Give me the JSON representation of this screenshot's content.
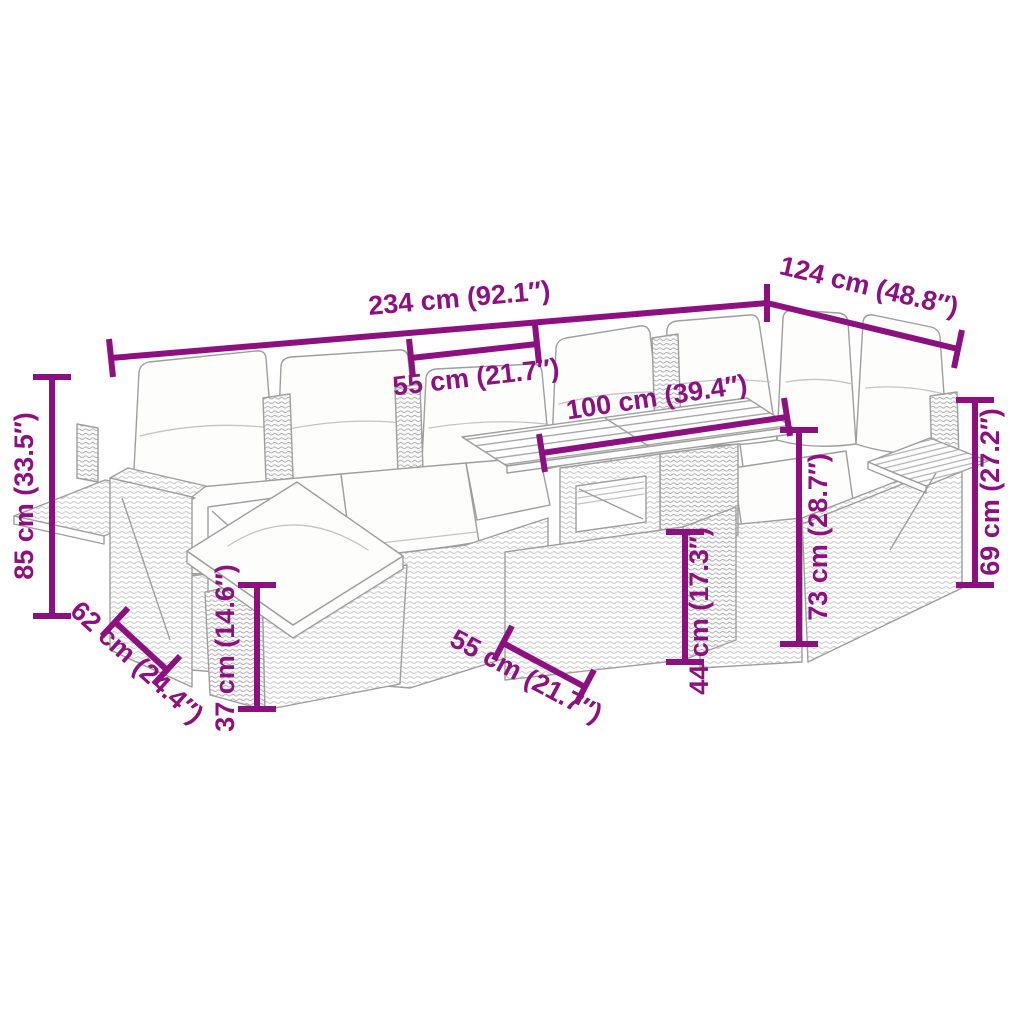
{
  "meta": {
    "diagram_type": "product-dimension-diagram",
    "subject": "rattan garden corner sofa set with cushions, footstool and table",
    "background_color": "#FFFFFF",
    "accent_color": "#8D1081",
    "sketch_line_color": "#9E9E9E"
  },
  "dimensions": {
    "sofa_total_width": "234 cm (92.1″)",
    "seat_module_width": "55 cm (21.7″)",
    "right_section_depth": "124 cm (48.8″)",
    "table_top_width": "100 cm (39.4″)",
    "backrest_height": "85 cm (33.5″)",
    "seat_depth": "62 cm (24.4″)",
    "footstool_height": "37 cm (14.6″)",
    "footstool_width": "55 cm (21.7″)",
    "table_height": "44 cm (17.3″)",
    "armrest_side_height": "73 cm (28.7″)",
    "right_backrest_height": "69 cm (27.2″)"
  }
}
